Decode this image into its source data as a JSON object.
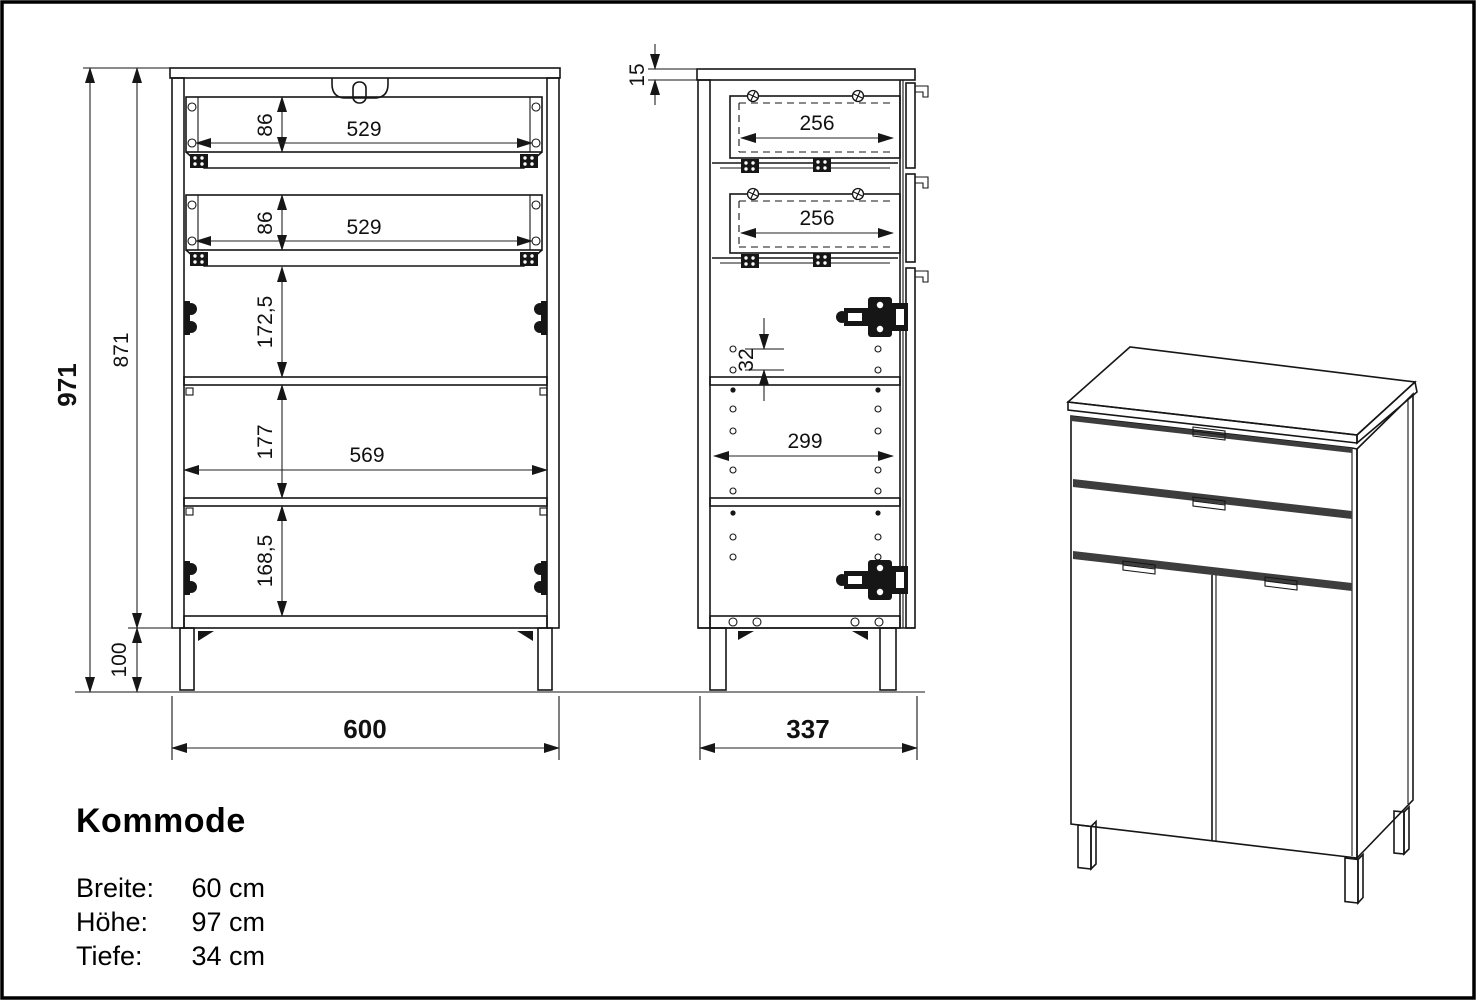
{
  "drawing": {
    "title": "Kommode",
    "specs": [
      {
        "label": "Breite:",
        "value": "60 cm"
      },
      {
        "label": "Höhe:",
        "value": "97 cm"
      },
      {
        "label": "Tiefe:",
        "value": "34 cm"
      }
    ],
    "front": {
      "total_height": "971",
      "carcass_height": "871",
      "leg_height": "100",
      "drawer1_height": "86",
      "drawer1_width": "529",
      "drawer2_height": "86",
      "drawer2_width": "529",
      "door_top_section": "172,5",
      "shelf_section": "177",
      "inner_width": "569",
      "bottom_section": "168,5",
      "total_width": "600"
    },
    "side": {
      "top_thickness": "15",
      "drawer1_depth": "256",
      "drawer2_depth": "256",
      "hole_pitch": "32",
      "inner_depth": "299",
      "total_depth": "337"
    }
  }
}
